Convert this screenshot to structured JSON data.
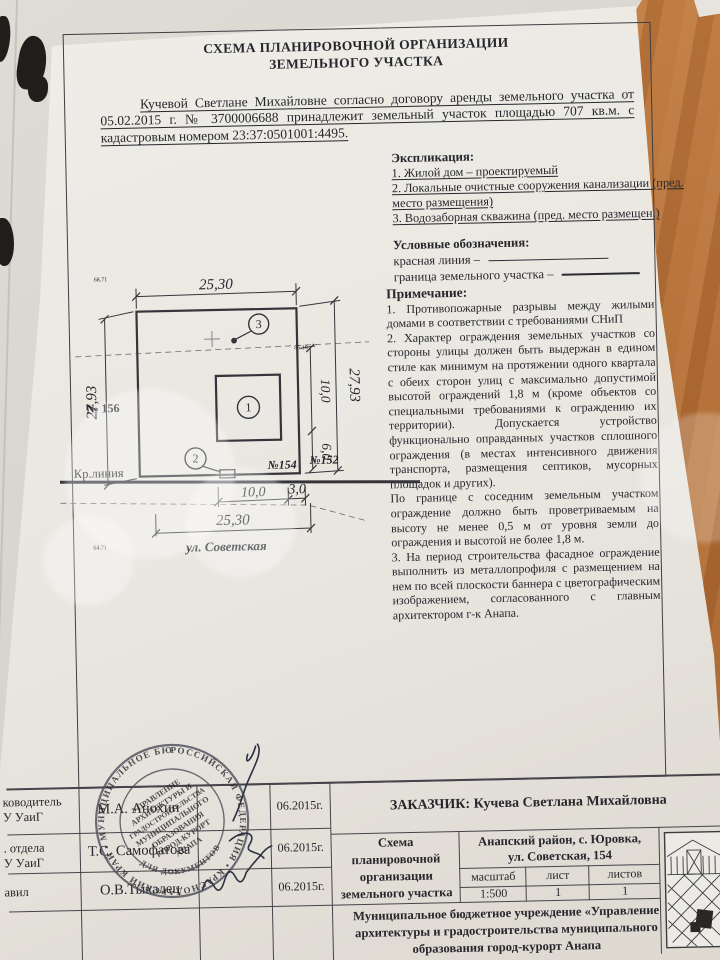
{
  "doc": {
    "title_line1": "СХЕМА ПЛАНИРОВОЧНОЙ ОРГАНИЗАЦИИ",
    "title_line2": "ЗЕМЕЛЬНОГО УЧАСТКА",
    "intro": "Кучевой Светлане Михайловне согласно договору аренды земельного участка от 05.02.2015 г. № 3700006688 принадлежит земельный участок площадью 707 кв.м. с кадастровым номером 23:37:0501001:4495.",
    "explication": {
      "heading": "Экспликация:",
      "item1": "1. Жилой дом – проектируемый",
      "item2": "2. Локальные очистные сооружения канализации (пред. место размещения)",
      "item3": "3. Водозаборная скважина (пред. место размещен.)"
    },
    "legend": {
      "heading": "Условные обозначения:",
      "item1": "красная линия –",
      "item2": "граница земельного участка –"
    },
    "notes": {
      "heading": "Примечание:",
      "p1": "1. Противопожарные разрывы между жилыми домами в соответствии с требованиями СНиП",
      "p2": "2. Характер ограждения земельных участков со стороны улицы должен быть выдержан в едином стиле как минимум на протяжении одного квартала с обеих сторон улиц с максимально допустимой высотой ограждений 1,8 м (кроме объектов со специальными требованиями к ограждению их территории). Допускается устройство функционально оправданных участков сплошного ограждения (в местах интенсивного движения транспорта, размещения септиков, мусорных площадок и других).",
      "p3": "По границе с соседним земельным участком ограждение должно быть проветриваемым на высоту не менее 0,5 м от уровня земли до ограждения и высотой не более 1,8 м.",
      "p4": "3. На период строительства фасадное ограждение выполнить из металлопрофиля с размещением на нем по всей плоскости баннера с цветографическим изображением, согласованного с главным архитектором г-к Анапа."
    }
  },
  "plan": {
    "dim_top": "25,30",
    "dim_left": "27,93",
    "dim_right": "27,93",
    "dim_right_upper": "10,0",
    "dim_right_lower": "6,0",
    "dim_bottom_1": "10,0",
    "dim_bottom_2": "3,0",
    "dim_bottom_total": "25,30",
    "street": "ул. Советская",
    "red_line_label": "Кр.линия",
    "parcel_left": "№ 156",
    "parcel_bottom": "№154",
    "parcel_right": "№152",
    "marker_house": "1",
    "marker_septic": "2",
    "marker_well": "3",
    "elev_top": "68.71",
    "elev_bottom": "64.71",
    "elev_right": "85.18"
  },
  "titleblock": {
    "rows": [
      {
        "role_l1": "ководитель",
        "role_l2": "У УаиГ",
        "name": "М.А. Анохин",
        "date": "06.2015г."
      },
      {
        "role_l1": ". отдела",
        "role_l2": "У УаиГ",
        "name": "Т.С. Самофатова",
        "date": "06.2015г."
      },
      {
        "role_l1": "авил",
        "role_l2": "",
        "name": "О.В.Тыкалец",
        "date": "06.2015г."
      }
    ],
    "customer": "ЗАКАЗЧИК:  Кучева Светлана Михайловна",
    "scheme_name": "Схема планировочной организации земельного участка",
    "address_line1": "Анапский район, с. Юровка,",
    "address_line2": "ул. Советская, 154",
    "scale_label": "масштаб",
    "sheet_label": "лист",
    "sheets_label": "листов",
    "scale_value": "1:500",
    "sheet_value": "1",
    "sheets_value": "1",
    "org_name": "Муниципальное бюджетное учреждение «Управление архитектуры и градостроительства муниципального образования город-курорт Анапа"
  },
  "stamp": {
    "ring": "РОССИЙСКАЯ ФЕДЕРАЦИЯ • КРАСНОДАРСКИЙ КРАЙ • МУНИЦИПАЛЬНОЕ БЮДЖЕТНОЕ УЧРЕЖДЕНИЕ •",
    "bottom": "ДЛЯ ДОКУМЕНТОВ",
    "center_lines": [
      "УПРАВЛЕНИЕ",
      "АРХИТЕКТУРЫ И",
      "ГРАДОСТРОИТЕЛЬСТВА",
      "МУНИЦИПАЛЬНОГО",
      "ОБРАЗОВАНИЯ",
      "ГОРОД-КУРОРТ",
      "АНАПА"
    ]
  }
}
